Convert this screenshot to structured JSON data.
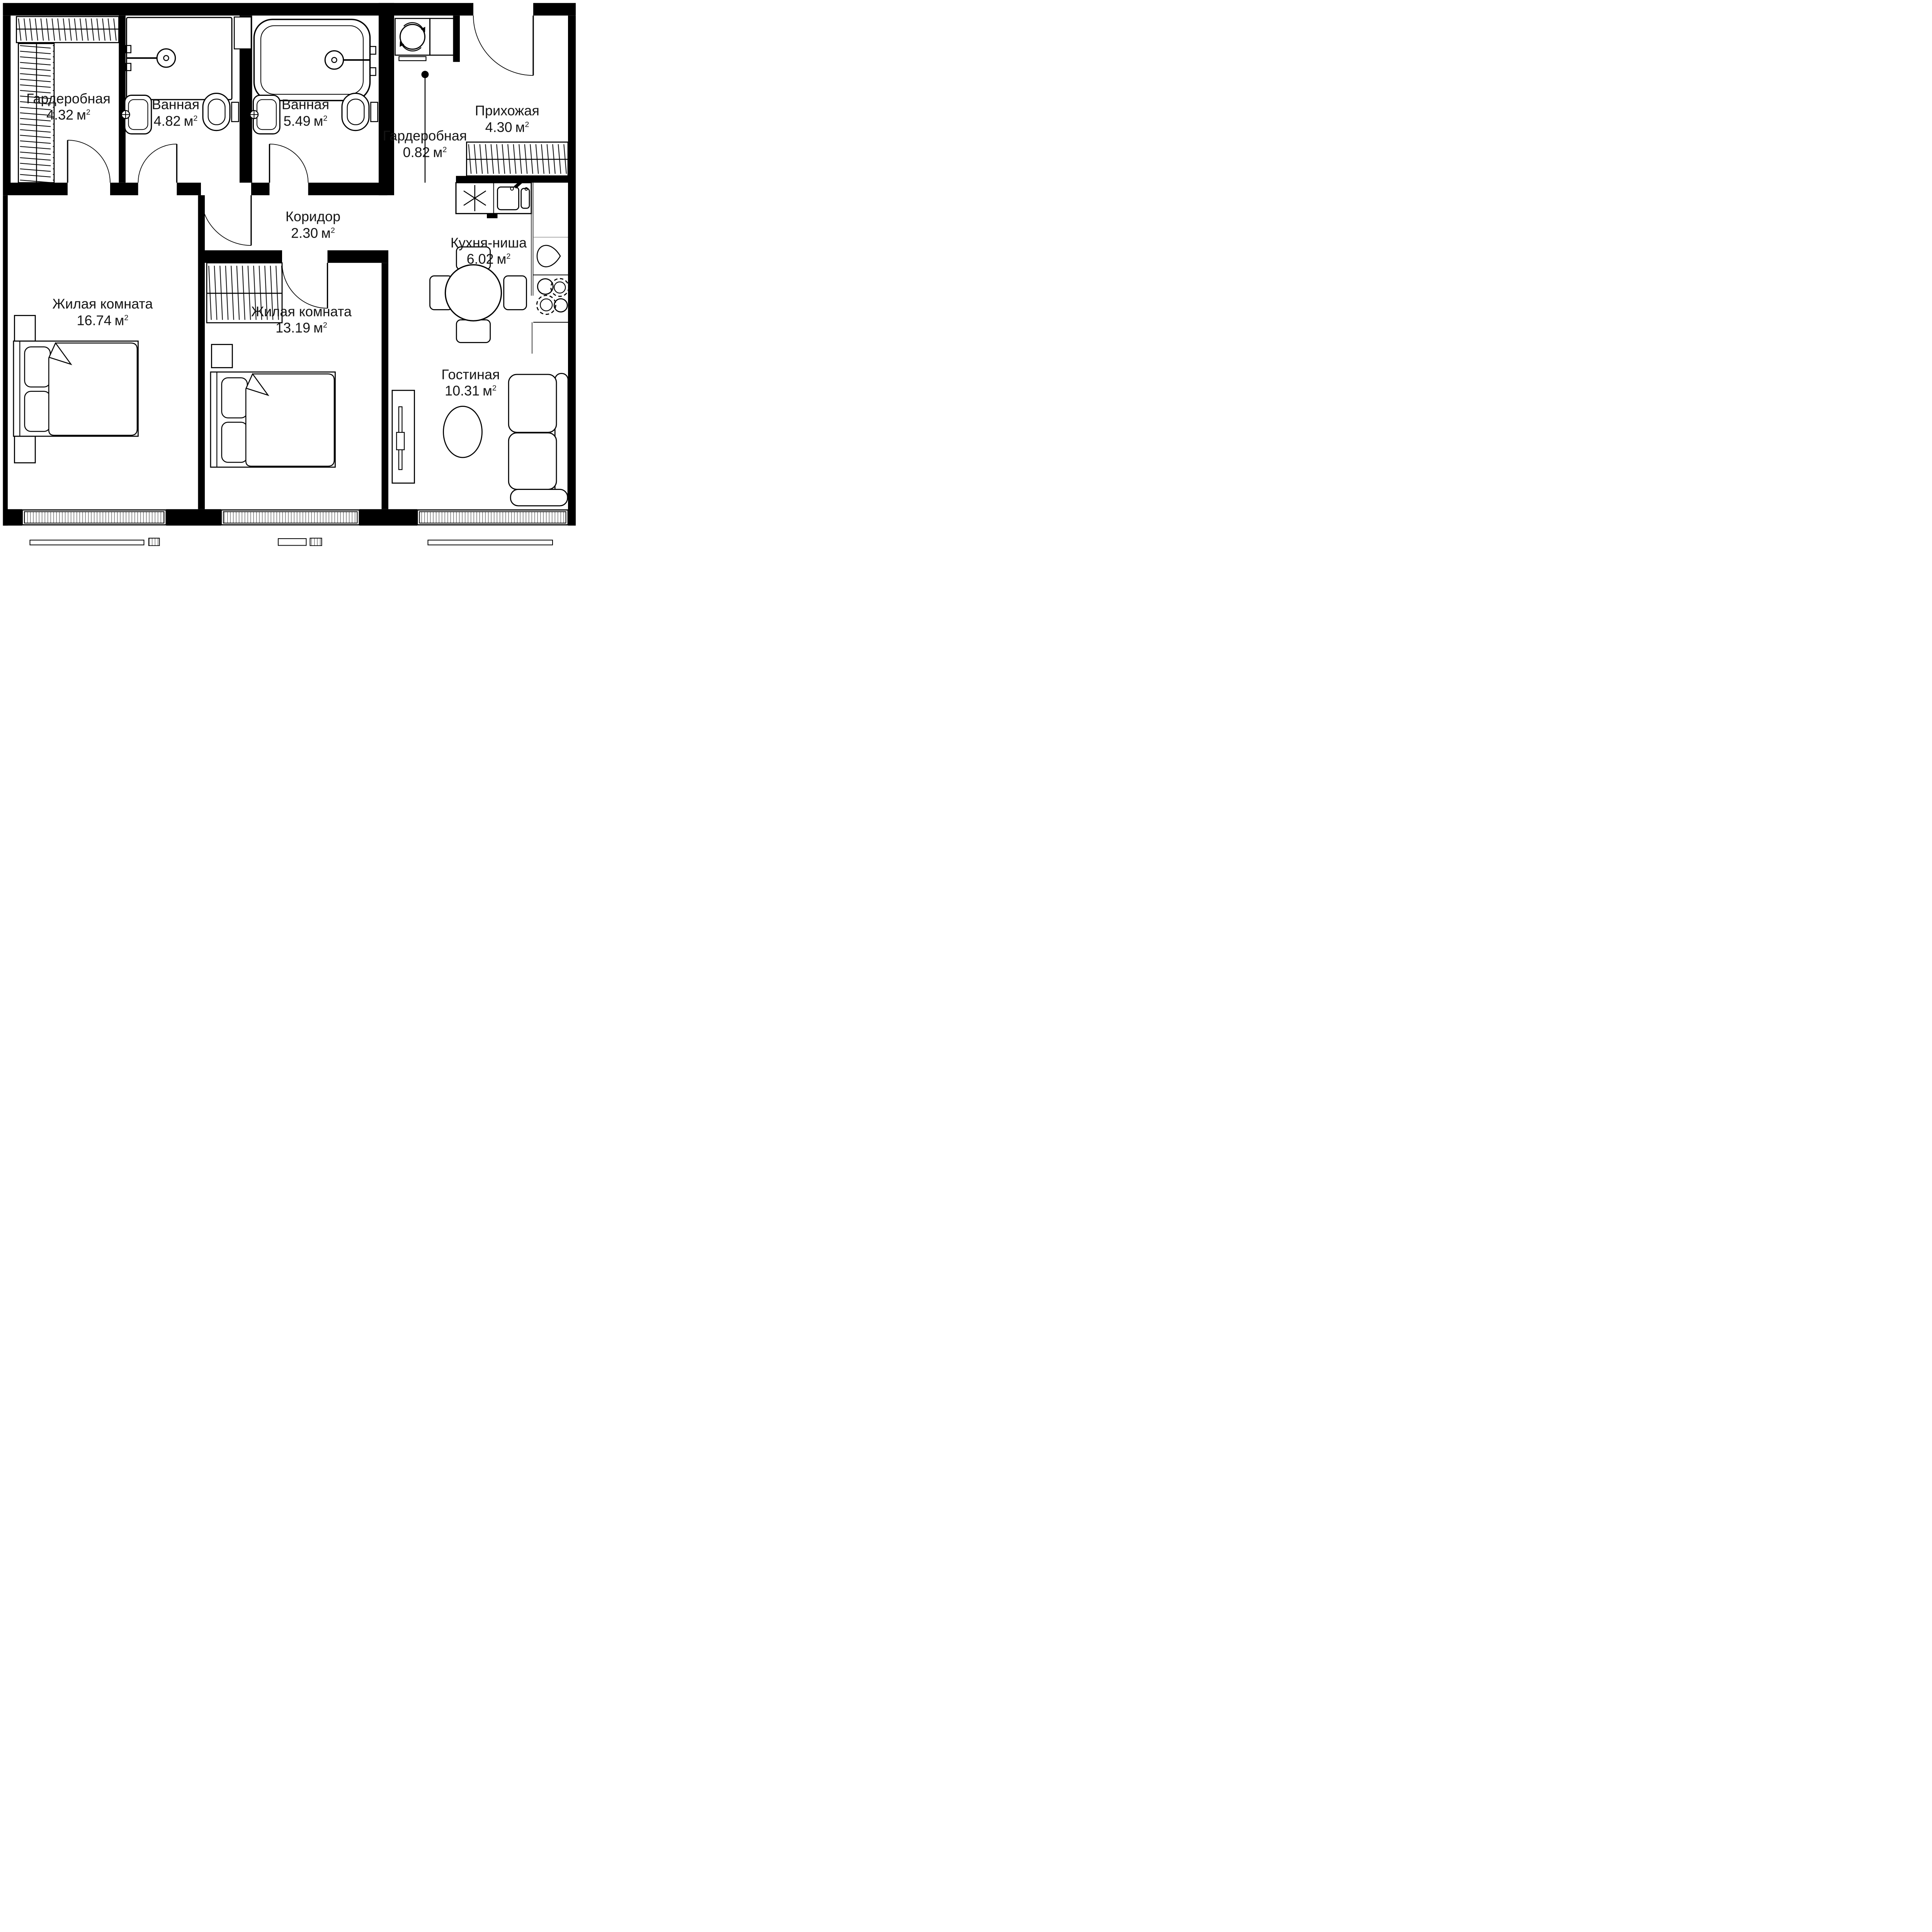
{
  "unit": {
    "symbol": "м",
    "sup": "2"
  },
  "rooms": [
    {
      "id": "wardrobe-1",
      "name": "Гардеробная",
      "area": "4.32"
    },
    {
      "id": "bathroom-1",
      "name": "Ванная",
      "area": "4.82"
    },
    {
      "id": "bathroom-2",
      "name": "Ванная",
      "area": "5.49"
    },
    {
      "id": "wardrobe-2",
      "name": "Гардеробная",
      "area": "0.82"
    },
    {
      "id": "hallway",
      "name": "Прихожая",
      "area": "4.30"
    },
    {
      "id": "corridor",
      "name": "Коридор",
      "area": "2.30"
    },
    {
      "id": "kitchen-niche",
      "name": "Кухня-ниша",
      "area": "6.02"
    },
    {
      "id": "living-room-1",
      "name": "Жилая комната",
      "area": "16.74"
    },
    {
      "id": "living-room-2",
      "name": "Жилая комната",
      "area": "13.19"
    },
    {
      "id": "lounge",
      "name": "Гостиная",
      "area": "10.31"
    }
  ]
}
